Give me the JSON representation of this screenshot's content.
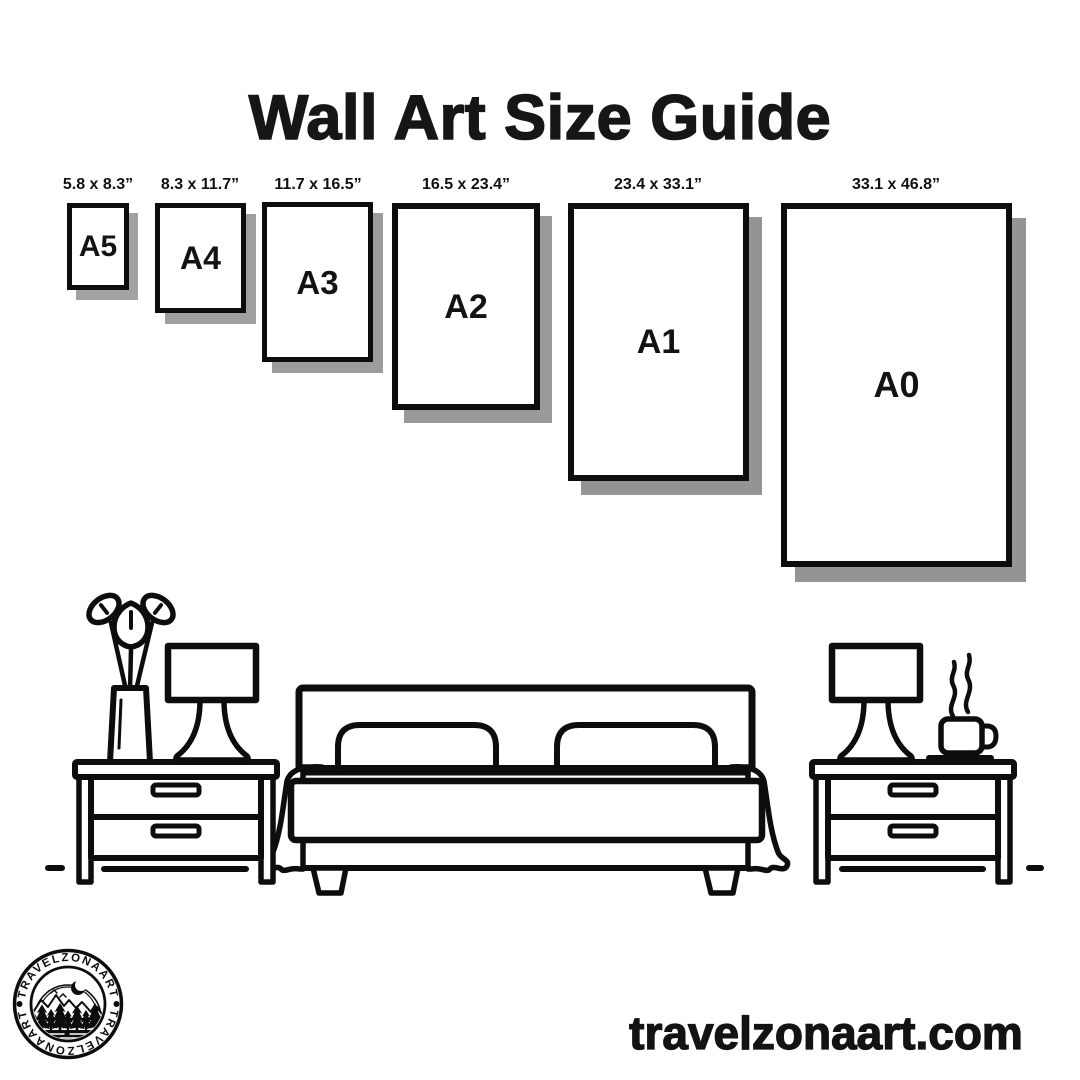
{
  "title": "Wall Art Size Guide",
  "sizes": [
    {
      "name": "A5",
      "dimensions": "5.8 x 8.3”"
    },
    {
      "name": "A4",
      "dimensions": "8.3 x 11.7”"
    },
    {
      "name": "A3",
      "dimensions": "11.7 x 16.5”"
    },
    {
      "name": "A2",
      "dimensions": "16.5 x 23.4”"
    },
    {
      "name": "A1",
      "dimensions": "23.4 x 33.1”"
    },
    {
      "name": "A0",
      "dimensions": "33.1 x 46.8”"
    }
  ],
  "illustration": {
    "icons": [
      "potted-plant-icon",
      "table-lamp-icon",
      "nightstand-icon",
      "double-bed-icon",
      "coffee-cup-icon",
      "floor-line"
    ]
  },
  "logo": {
    "top_text": "TRAVELZONAART",
    "bottom_text": "TRAVELZONAART",
    "separator": "•"
  },
  "footer": {
    "website": "travelzonaart.com"
  },
  "colors": {
    "ink": "#0d0d0d",
    "shadow": "#999999",
    "background": "#ffffff"
  }
}
